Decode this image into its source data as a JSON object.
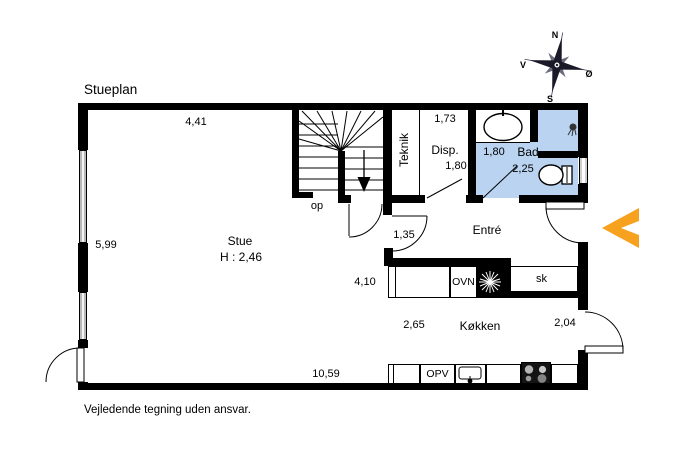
{
  "title": "Stueplan",
  "disclaimer": "Vejledende tegning uden ansvar.",
  "compass": {
    "north": "N",
    "south": "S",
    "west": "V",
    "east": "Ø"
  },
  "rooms": {
    "stue": {
      "name": "Stue",
      "ceiling_height": "H : 2,46"
    },
    "teknik": {
      "name": "Teknik"
    },
    "disp": {
      "name": "Disp."
    },
    "bad": {
      "name": "Bad"
    },
    "entre": {
      "name": "Entré"
    },
    "kokken": {
      "name": "Køkken"
    }
  },
  "dimensions": {
    "stue_top": "4,41",
    "stue_left": "5,99",
    "bottom": "10,59",
    "disp_width": "1,73",
    "disp_depth": "1,80",
    "bad_width": "1,80",
    "bad_depth": "2,25",
    "hall_door": "1,35",
    "counter": "4,10",
    "kokken_width": "2,65",
    "kokken_right": "2,04"
  },
  "labels": {
    "stairs_up": "op",
    "closet": "sk",
    "oven": "OVN",
    "dishwasher": "OPV"
  },
  "colors": {
    "bad_floor": "#b9d3f1",
    "entrance_arrow": "#f6a21e",
    "wall": "#000000"
  }
}
